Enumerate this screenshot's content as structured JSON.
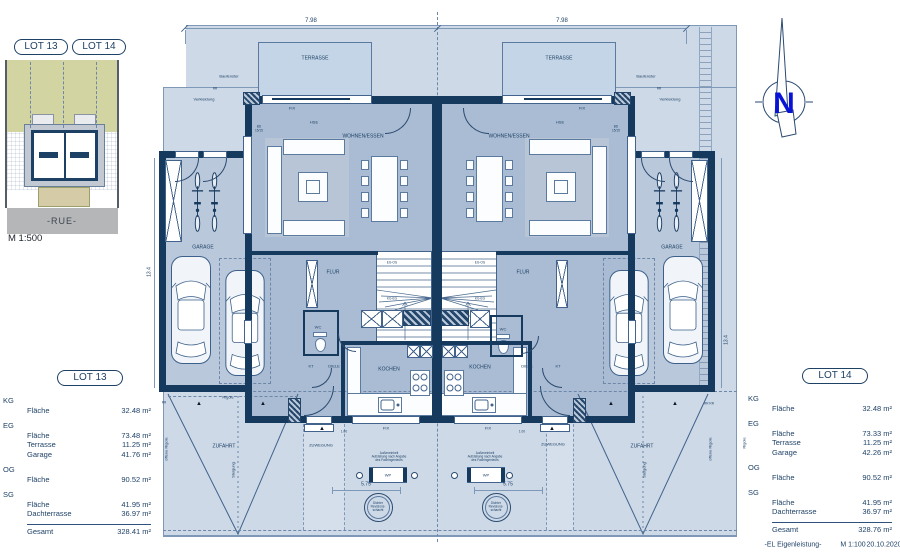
{
  "colors": {
    "wall_navy": "#16395e",
    "lot_bg": "#cdd9e7",
    "room_bg": "#a9bcd3",
    "terrace_bg": "#c3d5e6",
    "site_green": "#d2d5a2",
    "road_grey": "#b4b6b8",
    "north_blue": "#0813d6",
    "ink": "#1e4166"
  },
  "site_overview": {
    "street": "-RUE-",
    "scale": "M 1:500"
  },
  "north_arrow": {
    "letter": "N"
  },
  "dimensions": {
    "plan_width": "7.98",
    "plan_depth": "13.4",
    "entry_width": "5.75",
    "path": "1.00"
  },
  "rooms": {
    "terrasse": "TERRASSE",
    "wohnen_essen": "WOHNEN/ESSEN",
    "kochen": "KOCHEN",
    "flur": "FLUR",
    "diele": "DIELE",
    "wc": "WC",
    "kt": "KT",
    "garage": "GARAGE"
  },
  "openings": {
    "fix": "FIX",
    "hse": "HSE",
    "bd_l1": "BD",
    "bd_l2": "15/15"
  },
  "stairs": {
    "upper": "EG-OG",
    "lower": "KG-EG"
  },
  "site_labels": {
    "zufahrt": "ZUFAHRT",
    "zuwegung": "ZUWEGUNG",
    "steigung": "Steigung",
    "rigole": "Rigole",
    "offene_rigole": "offene Rigole",
    "rr": "RR",
    "rr_rr": "RR  RR",
    "baufenster": "Baufenster",
    "verkleidung": "Verkleidung"
  },
  "equipment": {
    "wp": "WP",
    "note_l1": "Außeneinheit",
    "note_l2": "Aufstellung nach Angabe",
    "note_l3": "des Fachingenieurs",
    "schacht_l1": "Dichter",
    "schacht_l2": "Revisions-",
    "schacht_l3": "schacht"
  },
  "icons": {
    "direction_marker": "▲"
  },
  "lot13": {
    "title": "LOT 13",
    "groups": [
      {
        "level": "KG",
        "items": [
          [
            "Fläche",
            "32.48 m²"
          ]
        ]
      },
      {
        "level": "EG",
        "items": [
          [
            "Fläche",
            "73.48 m²"
          ],
          [
            "Terrasse",
            "11.25 m²"
          ],
          [
            "Garage",
            "41.76 m²"
          ]
        ]
      },
      {
        "level": "OG",
        "items": [
          [
            "Fläche",
            "90.52 m²"
          ]
        ]
      },
      {
        "level": "SG",
        "items": [
          [
            "Fläche",
            "41.95 m²"
          ],
          [
            "Dachterrasse",
            "36.97 m²"
          ]
        ]
      }
    ],
    "total_label": "Gesamt",
    "total_value": "328.41 m²"
  },
  "lot14": {
    "title": "LOT 14",
    "groups": [
      {
        "level": "KG",
        "items": [
          [
            "Fläche",
            "32.48 m²"
          ]
        ]
      },
      {
        "level": "EG",
        "items": [
          [
            "Fläche",
            "73.33 m²"
          ],
          [
            "Terrasse",
            "11.25 m²"
          ],
          [
            "Garage",
            "42.26 m²"
          ]
        ]
      },
      {
        "level": "OG",
        "items": [
          [
            "Fläche",
            "90.52 m²"
          ]
        ]
      },
      {
        "level": "SG",
        "items": [
          [
            "Fläche",
            "41.95 m²"
          ],
          [
            "Dachterrasse",
            "36.97 m²"
          ]
        ]
      }
    ],
    "total_label": "Gesamt",
    "total_value": "328.76 m²"
  },
  "footer": {
    "credit": "-EL Eigenleistung-",
    "scale": "M 1:100",
    "date": "20.10.2020"
  }
}
